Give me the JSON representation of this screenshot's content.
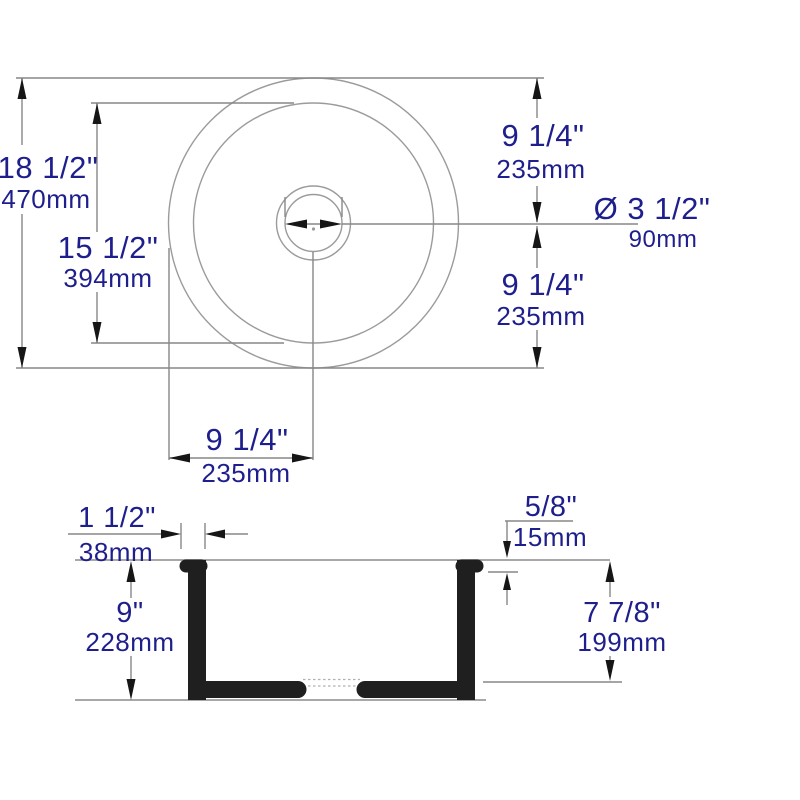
{
  "drawing": {
    "type": "sink-dimension-diagram",
    "colors": {
      "dimension_text": "#1e1e8c",
      "thin_line": "#9b9b9b",
      "dimension_line": "#878787",
      "arrow": "#161616",
      "section_solid": "#1f1f1f",
      "background": "#ffffff"
    },
    "top_view": {
      "overall_diameter": {
        "inches": "18 1/2\"",
        "metric": "470mm"
      },
      "basin_diameter": {
        "inches": "15 1/2\"",
        "metric": "394mm"
      },
      "center_to_top_radius": {
        "inches": "9 1/4\"",
        "metric": "235mm"
      },
      "center_to_bottom_radius": {
        "inches": "9 1/4\"",
        "metric": "235mm"
      },
      "edge_to_center_radius": {
        "inches": "9 1/4\"",
        "metric": "235mm"
      },
      "drain_diameter": {
        "inches": "Ø 3 1/2\"",
        "metric": "90mm"
      }
    },
    "section_view": {
      "rim_width": {
        "inches": "1 1/2\"",
        "metric": "38mm"
      },
      "rim_thickness": {
        "inches": "5/8\"",
        "metric": "15mm"
      },
      "overall_depth": {
        "inches": "9\"",
        "metric": "228mm"
      },
      "interior_depth": {
        "inches": "7 7/8\"",
        "metric": "199mm"
      }
    }
  }
}
